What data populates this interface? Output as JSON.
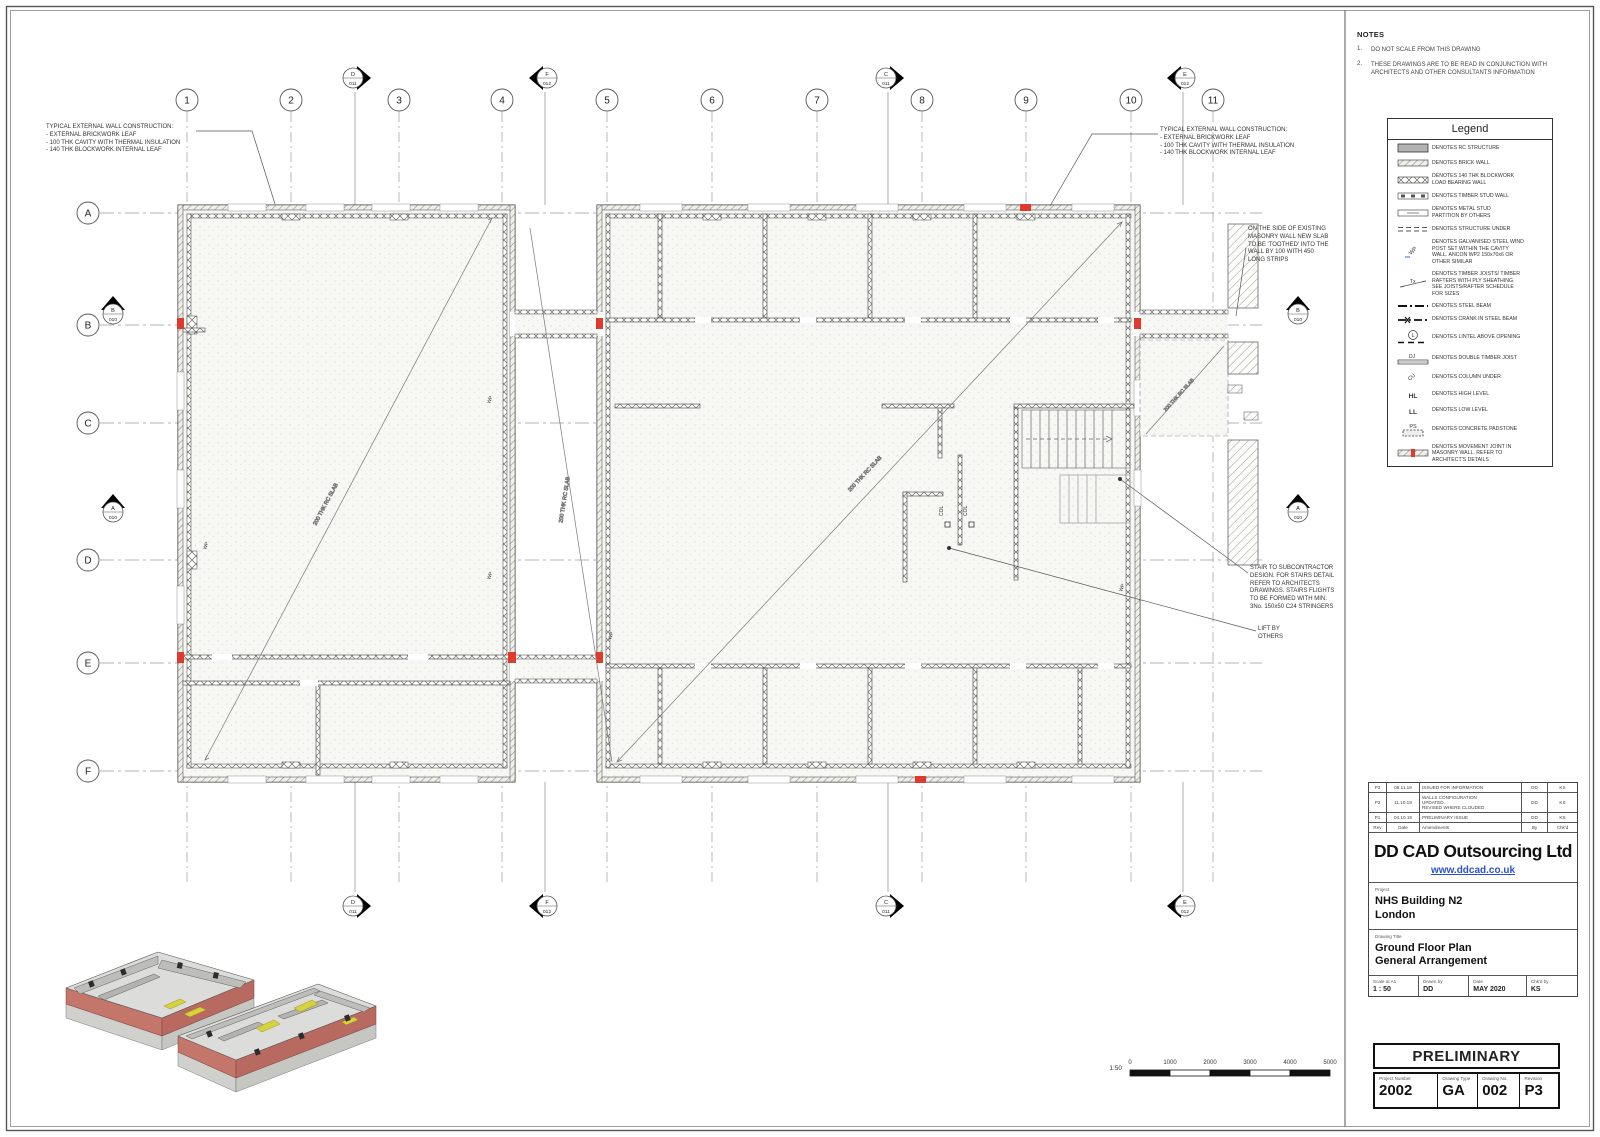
{
  "colors": {
    "accent_red": "#e03a2f",
    "url_blue": "#2a52c9",
    "iso_pink": "#c4766b",
    "iso_yellow": "#d8d23a"
  },
  "notes": {
    "title": "NOTES",
    "items": [
      {
        "num": "1.",
        "text": "DO NOT SCALE FROM THIS DRAWING"
      },
      {
        "num": "2.",
        "text": "THESE DRAWINGS ARE TO BE READ IN CONJUNCTION WITH\nARCHITECTS AND OTHER CONSULTANTS INFORMATION"
      }
    ]
  },
  "legend": {
    "title": "Legend",
    "items": [
      {
        "symbol": "rc-structure",
        "label": "DENOTES RC STRUCTURE"
      },
      {
        "symbol": "brick-wall",
        "label": "DENOTES BRICK WALL"
      },
      {
        "symbol": "blockwork-wall",
        "label": "DENOTES 140 THK BLOCKWORK\nLOAD BEARING WALL"
      },
      {
        "symbol": "timber-stud-wall",
        "label": "DENOTES TIMBER STUD WALL"
      },
      {
        "symbol": "metal-stud-partition",
        "label": "DENOTES METAL STUD\nPARTITION BY OTHERS"
      },
      {
        "symbol": "structure-under",
        "label": "DENOTES STRUCTURE UNDER"
      },
      {
        "symbol": "wind-post",
        "label": "DENOTES GALVANISED STEEL WIND\nPOST SET WITHIN THE CAVITY\nWALL. ANCON WP2 150x70x6 OR\nOTHER SIMILAR"
      },
      {
        "symbol": "timber-joists",
        "label": "DENOTES TIMBER JOISTS/ TIMBER\nRAFTERS WITH PLY SHEATHING.\nSEE JOISTS/RAFTER SCHEDULE\nFOR SIZES"
      },
      {
        "symbol": "steel-beam",
        "label": "DENOTES STEEL BEAM"
      },
      {
        "symbol": "crank-steel-beam",
        "label": "DENOTES CRANK IN STEEL BEAM"
      },
      {
        "symbol": "lintel",
        "label": "DENOTES LINTEL ABOVE OPENING"
      },
      {
        "symbol": "double-timber-joist",
        "label": "DENOTES DOUBLE TIMBER JOIST"
      },
      {
        "symbol": "column-under",
        "label": "DENOTES COLUMN UNDER"
      },
      {
        "symbol": "high-level",
        "label": "DENOTES HIGH LEVEL"
      },
      {
        "symbol": "low-level",
        "label": "DENOTES LOW LEVEL"
      },
      {
        "symbol": "concrete-padstone",
        "label": "DENOTES CONCRETE PADSTONE"
      },
      {
        "symbol": "movement-joint",
        "label": "DENOTES MOVEMENT JOINT IN\nMASONRY WALL. REFER TO\nARCHITECT'S DETAILS"
      }
    ],
    "symbol_texts": {
      "wp": "WP",
      "tx": "Tx",
      "l": "L",
      "dj": "DJ",
      "cu": "CU",
      "hl": "HL",
      "ll": "LL",
      "ps": "PS"
    }
  },
  "plan": {
    "grid_columns": [
      "1",
      "2",
      "3",
      "4",
      "5",
      "6",
      "7",
      "8",
      "9",
      "10",
      "11"
    ],
    "grid_rows": [
      "A",
      "B",
      "C",
      "D",
      "E",
      "F"
    ],
    "section_markers": {
      "d": {
        "letter": "D",
        "num": "011"
      },
      "f": {
        "letter": "F",
        "num": "012"
      },
      "c": {
        "letter": "C",
        "num": "011"
      },
      "e": {
        "letter": "E",
        "num": "012"
      },
      "b": {
        "letter": "B",
        "num": "010"
      },
      "a": {
        "letter": "A",
        "num": "010"
      }
    },
    "labels": {
      "slab": "200 THK RC SLAB",
      "wp": "WP",
      "col": "COL"
    },
    "annotations": {
      "wall_construction": "TYPICAL EXTERNAL WALL CONSTRUCTION:\n- EXTERNAL BRICKWORK LEAF\n- 100 THK CAVITY WITH THERMAL INSULATION\n- 140 THK BLOCKWORK INTERNAL LEAF",
      "toothed": "ON THE SIDE OF EXISTING\nMASONRY WALL NEW SLAB\nTO BE 'TOOTHED' INTO THE\nWALL BY 100 WITH 450\nLONG STRIPS",
      "stair": "STAIR TO SUBCONTRACTOR\nDESIGN. FOR STAIRS DETAIL\nREFER TO ARCHITECTS\nDRAWINGS. STAIRS FLIGHTS\nTO BE FORMED WITH MIN.\n3No. 150x50 C24 STRINGERS",
      "lift": "LIFT BY\nOTHERS"
    },
    "scale_bar": {
      "ratio": "1:50",
      "ticks": [
        "0",
        "1000",
        "2000",
        "3000",
        "4000",
        "5000"
      ]
    }
  },
  "revisions": {
    "header": {
      "rev": "Rev",
      "date": "Date",
      "amendments": "Amendments",
      "by": "By",
      "chkd": "Chk'd"
    },
    "rows": [
      {
        "rev": "P3",
        "date": "06.11.19",
        "amendments": "ISSUED FOR INFORMATION",
        "by": "DD",
        "chkd": "KS"
      },
      {
        "rev": "P2",
        "date": "11.10.19",
        "amendments": "WALLS CONFIGURATION\nUPDATED.\nREVISED WHERE CLOUDED",
        "by": "DD",
        "chkd": "KS"
      },
      {
        "rev": "P1",
        "date": "04.10.19",
        "amendments": "PRELIMINARY ISSUE",
        "by": "DD",
        "chkd": "KS"
      }
    ]
  },
  "company": {
    "name": "DD CAD Outsourcing Ltd",
    "website": "www.ddcad.co.uk"
  },
  "title_block": {
    "project_label": "Project",
    "project": "NHS Building N2\nLondon",
    "drawing_title_label": "Drawing Title",
    "drawing_title": "Ground Floor Plan\nGeneral Arrangement",
    "scale_label": "Scale at A1",
    "scale": "1 : 50",
    "drawn_label": "Drawn by",
    "drawn": "DD",
    "date_label": "Date",
    "date": "MAY 2020",
    "checked_label": "Chk'd by",
    "checked": "KS",
    "status": "PRELIMINARY",
    "project_number_label": "Project Number",
    "project_number": "2002",
    "drawing_type_label": "Drawing Type",
    "drawing_type": "GA",
    "drawing_no_label": "Drawing No.",
    "drawing_no": "002",
    "revision_label": "Revision",
    "revision": "P3"
  }
}
